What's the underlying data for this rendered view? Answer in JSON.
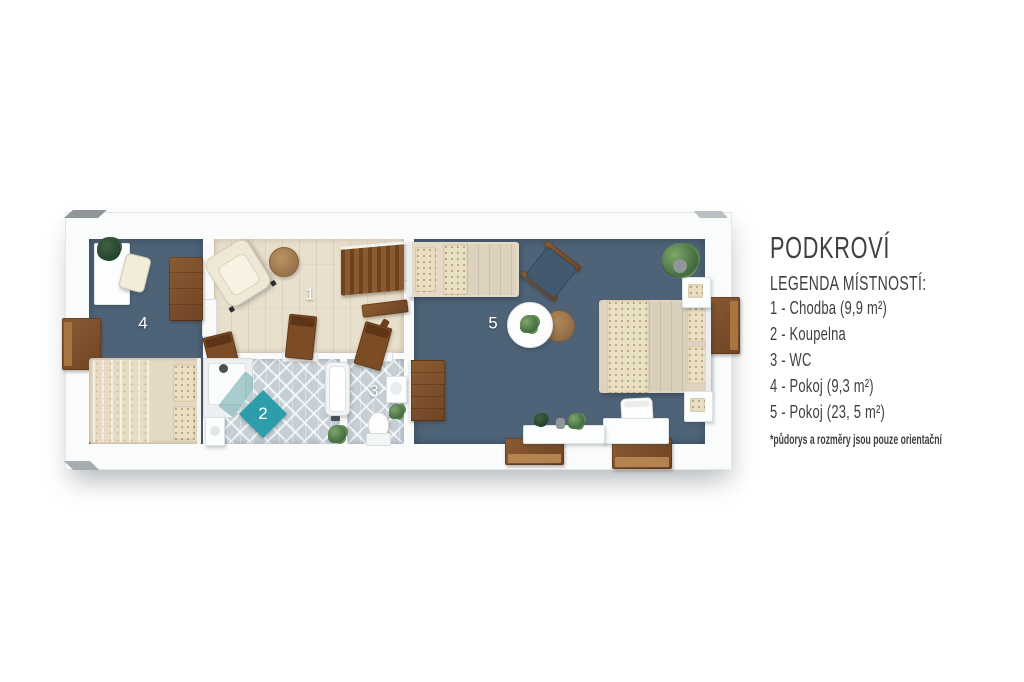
{
  "legend": {
    "title": "PODKROVÍ",
    "subtitle": "LEGENDA MÍSTNOSTÍ:",
    "items": [
      "1 - Chodba (9,9 m²)",
      "2 - Koupelna",
      "3 - WC",
      "4 - Pokoj (9,3 m²)",
      "5 - Pokoj (23, 5 m²)"
    ],
    "footnote": "*půdorys a rozměry jsou pouze orientační"
  },
  "plan": {
    "room_numbers": [
      "1",
      "2",
      "3",
      "4",
      "5"
    ],
    "colors": {
      "floor_blue": "#4f6378",
      "floor_wood": "#e9dfcd",
      "floor_tile": "#c5cfd5",
      "wall_white": "#fafbfb",
      "wood_furniture": "#7c4c26",
      "accent_teal": "#2d9dab",
      "bedding_cream": "#e7dcc4",
      "text": "#3f3f3f"
    }
  }
}
